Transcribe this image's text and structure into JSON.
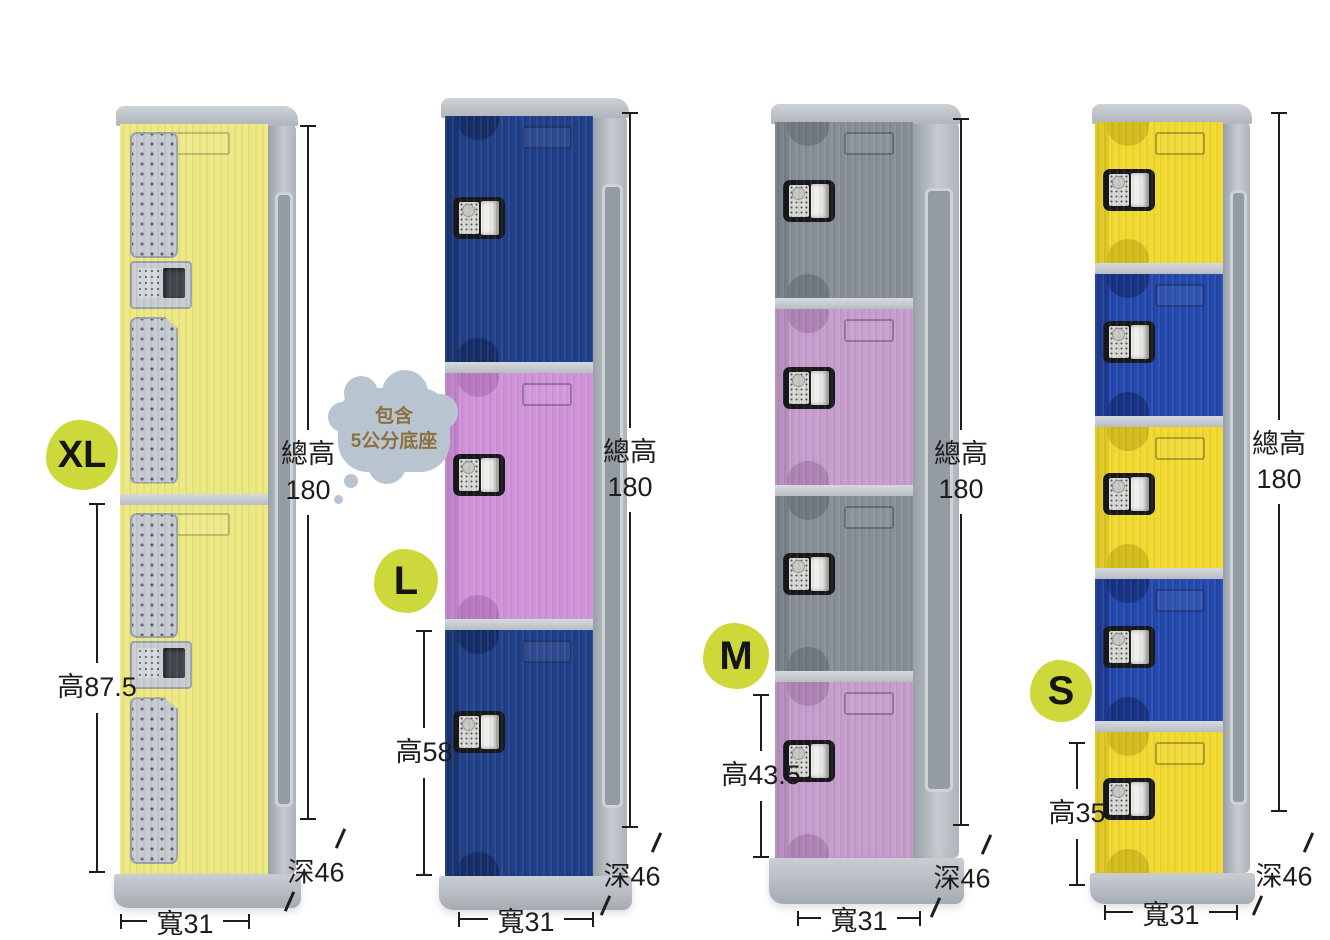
{
  "page": {
    "description": "ABS plastic locker size comparison diagram"
  },
  "badge_bg": "#cdd93b",
  "bubble": {
    "line1": "包含",
    "line2": "5公分底座",
    "bg": "#b9c4d1",
    "fg": "#8a713f"
  },
  "dim_color": "#1d1d1d",
  "lockers": [
    {
      "id": "xl",
      "label": "XL",
      "door_style": "vent",
      "door_count": 2,
      "doors": [
        {
          "color": "#ede982",
          "accent": "#d6cf69"
        },
        {
          "color": "#ede982",
          "accent": "#d6cf69"
        }
      ],
      "dims": {
        "total_label": "總高",
        "total_value": "180",
        "height": "高87.5",
        "width": "寬31",
        "depth": "深46"
      }
    },
    {
      "id": "l",
      "label": "L",
      "door_style": "bump",
      "door_count": 3,
      "doors": [
        {
          "color": "#21408a",
          "accent": "#152c63"
        },
        {
          "color": "#d093d8",
          "accent": "#b577bf"
        },
        {
          "color": "#21408a",
          "accent": "#152c63"
        }
      ],
      "dims": {
        "total_label": "總高",
        "total_value": "180",
        "height": "高58",
        "width": "寬31",
        "depth": "深46"
      }
    },
    {
      "id": "m",
      "label": "M",
      "door_style": "bump",
      "door_count": 4,
      "doors": [
        {
          "color": "#878e96",
          "accent": "#6d747c"
        },
        {
          "color": "#c69dcc",
          "accent": "#a981b0"
        },
        {
          "color": "#878e96",
          "accent": "#6d747c"
        },
        {
          "color": "#c69dcc",
          "accent": "#a981b0"
        }
      ],
      "dims": {
        "total_label": "總高",
        "total_value": "180",
        "height": "高43.5",
        "width": "寬31",
        "depth": "深46"
      }
    },
    {
      "id": "s",
      "label": "S",
      "door_style": "bump",
      "door_count": 5,
      "doors": [
        {
          "color": "#f2d930",
          "accent": "#cfb81c"
        },
        {
          "color": "#2448ac",
          "accent": "#16307d"
        },
        {
          "color": "#f2d930",
          "accent": "#cfb81c"
        },
        {
          "color": "#2448ac",
          "accent": "#16307d"
        },
        {
          "color": "#f2d930",
          "accent": "#cfb81c"
        }
      ],
      "dims": {
        "total_label": "總高",
        "total_value": "180",
        "height": "高35",
        "width": "寬31",
        "depth": "深46"
      }
    }
  ]
}
